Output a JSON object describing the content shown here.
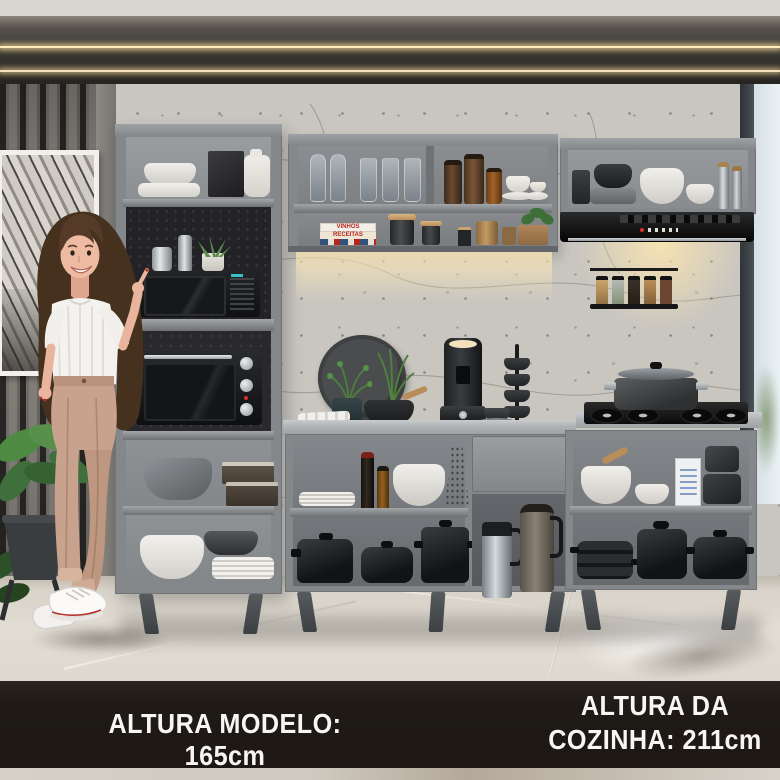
{
  "banner": {
    "left_label": "ALTURA MODELO: 165cm",
    "right_line1": "ALTURA DA",
    "right_line2": "COZINHA: 211cm"
  },
  "decor_text": {
    "book_spine_top": "VINHOS",
    "book_spine_mid": "RECEITAS"
  },
  "colors": {
    "banner_bg": "#211c18",
    "banner_text": "#f7f6f4",
    "cabinet_grey": "#85888b",
    "counter_grey": "#bcbfc1",
    "appliance_black": "#17181a",
    "led_warm": "#ffe8b8",
    "marble_wall": "#c9c6c0",
    "slat_wall": "#6f6d69",
    "floor": "#ded9d0",
    "plant_green": "#4e7d42",
    "trousers_tan": "#c8a28c",
    "top_white": "#f4f2ef",
    "hair_brown": "#4a3428"
  }
}
